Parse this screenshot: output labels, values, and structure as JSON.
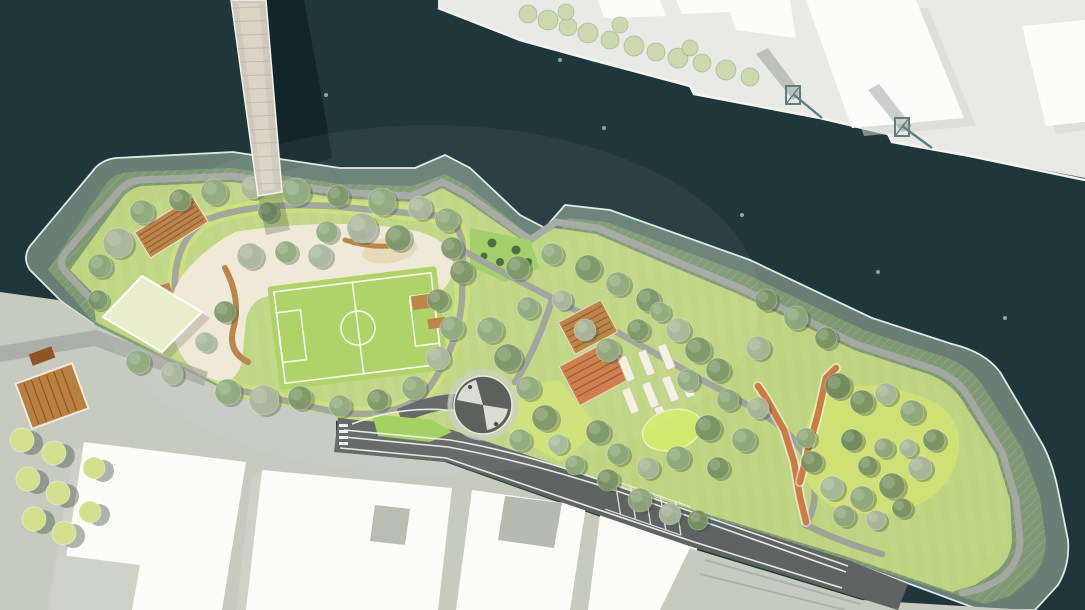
{
  "meta": {
    "title": "Waterfront park master plan — aerial rendering",
    "view": "top-down site plan",
    "visible_text": "none"
  },
  "palette": {
    "water": "#1f363a",
    "water_dot": "#8ea6a1",
    "cast_shadow": "rgba(8,24,28,0.55)",
    "quay": "#e9eae5",
    "quay_edge": "#f4f4ef",
    "building": "#fcfcfb",
    "building_shadow": "#d3d6cf",
    "crane": "#5f7e7f",
    "terrace": "rgba(163,188,165,0.55)",
    "terrace_edge": "#dfe9e1",
    "embankment": "#7d9873",
    "crest_path": "#a3a8a0",
    "walk": "#9aa099",
    "lawn": "#bcd47f",
    "lawn_bright": "#cfe176",
    "field": "#abd161",
    "field_line": "#ffffff",
    "playground": "#efe9d6",
    "sand": "#e6d9b8",
    "wood": "#b97f41",
    "wood_dark": "#8f5527",
    "orange": "#cd7a45",
    "road": "#5f6462",
    "road_line": "#f2f3ef",
    "island": "#9fcf5c",
    "plaza": "#c7cabf",
    "plaza_dark": "#9fa49a",
    "pond": "#d2e86f",
    "bed": "#f3f1e3",
    "pavilion": "#e9edca",
    "bush": "#9fce63",
    "bush_dot": "#47663c",
    "bridge_deck": "#cfc8bc",
    "bridge_center": "#ddd6c9",
    "tree_tones": [
      "#8fa97c",
      "#7a9464",
      "#a9b89a",
      "#6f8a5e"
    ],
    "tree_pale": "#ccd8ae",
    "tree_yellow": "#d4e08d",
    "tree_shadow": "rgba(55,75,55,0.35)"
  },
  "scene": {
    "features": [
      {
        "name": "river-water",
        "kind": "water body"
      },
      {
        "name": "pedestrian-bridge",
        "kind": "bridge crossing river at top left"
      },
      {
        "name": "north-quay",
        "kind": "industrial quay with buildings and two harbor cranes, top right"
      },
      {
        "name": "flood-protection-berm",
        "kind": "green embankment ringing the park with tidal terrace edge"
      },
      {
        "name": "playground",
        "kind": "sand-colored play landscape with timber elements, west lobe"
      },
      {
        "name": "soccer-field",
        "kind": "lined sports pitch inside playground loop"
      },
      {
        "name": "pavilion-canopy",
        "kind": "square rotated canopy at west plaza entry"
      },
      {
        "name": "spiral-lookout-plaza",
        "kind": "dark circular plaza with two light ramps, center"
      },
      {
        "name": "community-garden-beds",
        "kind": "rows of planter slats, center-east"
      },
      {
        "name": "terraced-timber-seating",
        "kind": "two striped orange decks mid park"
      },
      {
        "name": "meadow-pond",
        "kind": "bright oval clearing east of gardens"
      },
      {
        "name": "switchback-ramp",
        "kind": "orange zig-zag ramp down east slope"
      },
      {
        "name": "waterfront-road",
        "kind": "road with lane markings along south edge of park"
      },
      {
        "name": "south-urban-blocks",
        "kind": "white building slabs with plazas, bottom"
      },
      {
        "name": "street-tree-rows",
        "kind": "small trees on southwest plaza and north quay"
      }
    ],
    "buoys": [
      [
        326,
        95
      ],
      [
        560,
        60
      ],
      [
        604,
        128
      ],
      [
        742,
        215
      ],
      [
        878,
        272
      ],
      [
        1005,
        318
      ]
    ],
    "trees_park": [
      [
        118,
        243,
        15,
        2
      ],
      [
        100,
        266,
        12,
        0
      ],
      [
        142,
        212,
        12,
        0
      ],
      [
        180,
        200,
        11,
        1
      ],
      [
        214,
        192,
        13,
        0
      ],
      [
        252,
        188,
        11,
        2
      ],
      [
        296,
        192,
        14,
        0
      ],
      [
        338,
        196,
        11,
        1
      ],
      [
        382,
        202,
        14,
        0
      ],
      [
        420,
        208,
        12,
        2
      ],
      [
        447,
        220,
        12,
        0
      ],
      [
        362,
        228,
        15,
        2
      ],
      [
        327,
        232,
        11,
        0
      ],
      [
        398,
        238,
        13,
        1
      ],
      [
        452,
        248,
        11,
        1
      ],
      [
        462,
        272,
        12,
        1
      ],
      [
        250,
        256,
        13,
        2
      ],
      [
        286,
        252,
        11,
        0
      ],
      [
        320,
        256,
        12,
        2
      ],
      [
        98,
        300,
        10,
        1
      ],
      [
        138,
        362,
        12,
        0
      ],
      [
        172,
        374,
        11,
        2
      ],
      [
        228,
        392,
        13,
        0
      ],
      [
        264,
        400,
        15,
        2
      ],
      [
        300,
        398,
        12,
        1
      ],
      [
        225,
        312,
        11,
        1
      ],
      [
        205,
        342,
        10,
        2
      ],
      [
        438,
        300,
        11,
        1
      ],
      [
        452,
        328,
        12,
        0
      ],
      [
        438,
        358,
        12,
        2
      ],
      [
        414,
        388,
        12,
        0
      ],
      [
        378,
        400,
        11,
        1
      ],
      [
        340,
        406,
        11,
        0
      ],
      [
        268,
        212,
        10,
        1
      ],
      [
        518,
        268,
        12,
        1
      ],
      [
        552,
        254,
        11,
        0
      ],
      [
        588,
        268,
        13,
        1
      ],
      [
        618,
        284,
        12,
        0
      ],
      [
        648,
        300,
        12,
        1
      ],
      [
        562,
        300,
        10,
        2
      ],
      [
        528,
        308,
        11,
        0
      ],
      [
        490,
        330,
        13,
        0
      ],
      [
        508,
        358,
        14,
        1
      ],
      [
        528,
        388,
        12,
        0
      ],
      [
        545,
        418,
        13,
        1
      ],
      [
        520,
        440,
        11,
        0
      ],
      [
        558,
        444,
        10,
        2
      ],
      [
        598,
        432,
        12,
        1
      ],
      [
        618,
        454,
        11,
        0
      ],
      [
        585,
        330,
        11,
        2
      ],
      [
        608,
        350,
        12,
        0
      ],
      [
        638,
        330,
        11,
        1
      ],
      [
        660,
        312,
        10,
        0
      ],
      [
        678,
        330,
        12,
        2
      ],
      [
        698,
        350,
        13,
        1
      ],
      [
        688,
        380,
        11,
        0
      ],
      [
        718,
        370,
        12,
        1
      ],
      [
        728,
        400,
        11,
        0
      ],
      [
        708,
        428,
        13,
        1
      ],
      [
        678,
        458,
        12,
        0
      ],
      [
        648,
        468,
        11,
        2
      ],
      [
        718,
        468,
        11,
        1
      ],
      [
        744,
        440,
        12,
        0
      ],
      [
        758,
        408,
        11,
        2
      ],
      [
        575,
        465,
        10,
        0
      ],
      [
        608,
        480,
        11,
        1
      ],
      [
        640,
        500,
        12,
        0
      ],
      [
        670,
        514,
        11,
        2
      ],
      [
        698,
        520,
        10,
        1
      ],
      [
        766,
        300,
        11,
        1
      ],
      [
        796,
        318,
        12,
        0
      ],
      [
        826,
        338,
        11,
        1
      ],
      [
        758,
        348,
        12,
        2
      ],
      [
        838,
        386,
        13,
        3
      ],
      [
        862,
        402,
        12,
        1
      ],
      [
        886,
        394,
        11,
        2
      ],
      [
        912,
        412,
        12,
        0
      ],
      [
        934,
        440,
        11,
        1
      ],
      [
        920,
        468,
        12,
        2
      ],
      [
        892,
        486,
        13,
        1
      ],
      [
        862,
        498,
        12,
        0
      ],
      [
        832,
        488,
        12,
        2
      ],
      [
        812,
        462,
        11,
        1
      ],
      [
        806,
        438,
        10,
        0
      ],
      [
        852,
        440,
        11,
        3
      ],
      [
        884,
        448,
        10,
        0
      ],
      [
        908,
        448,
        9,
        2
      ],
      [
        868,
        466,
        10,
        1
      ],
      [
        844,
        516,
        11,
        0
      ],
      [
        876,
        520,
        10,
        2
      ],
      [
        902,
        508,
        10,
        1
      ]
    ],
    "trees_quay": [
      [
        528,
        14,
        9
      ],
      [
        548,
        20,
        10
      ],
      [
        568,
        27,
        9
      ],
      [
        588,
        33,
        10
      ],
      [
        610,
        40,
        9
      ],
      [
        634,
        46,
        10
      ],
      [
        656,
        52,
        9
      ],
      [
        678,
        58,
        10
      ],
      [
        702,
        63,
        9
      ],
      [
        726,
        70,
        10
      ],
      [
        750,
        77,
        9
      ],
      [
        566,
        12,
        8
      ],
      [
        620,
        25,
        8
      ],
      [
        690,
        48,
        8
      ]
    ],
    "trees_plaza": [
      [
        22,
        440,
        12
      ],
      [
        54,
        453,
        12
      ],
      [
        28,
        479,
        12
      ],
      [
        58,
        493,
        12
      ],
      [
        34,
        519,
        12
      ],
      [
        64,
        533,
        12
      ],
      [
        94,
        468,
        11
      ],
      [
        90,
        512,
        11
      ]
    ]
  }
}
